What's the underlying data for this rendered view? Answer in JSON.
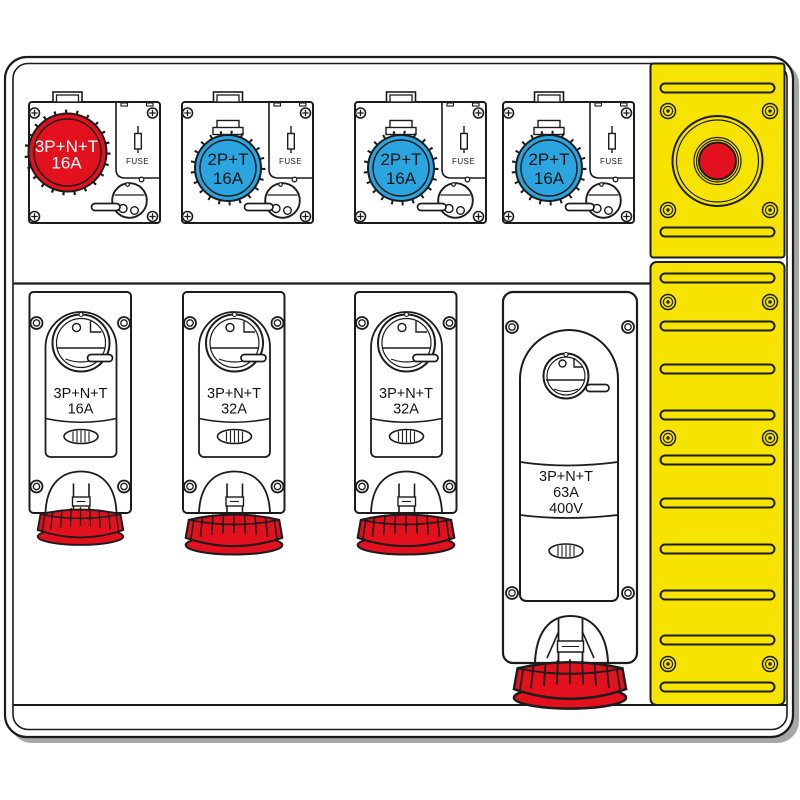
{
  "board": {
    "description": "Portable power distribution board technical illustration",
    "colors": {
      "socket_red": "#e3101e",
      "socket_blue": "#2aa5df",
      "panel_yellow": "#f6e300",
      "cap_red": "#e3101e",
      "estop_red": "#e3101e",
      "line": "#1c1c1c"
    }
  },
  "top_units": [
    {
      "socket_line1": "3P+N+T",
      "socket_line2": "16A",
      "fuse_label": "FUSE"
    },
    {
      "socket_line1": "2P+T",
      "socket_line2": "16A",
      "fuse_label": "FUSE"
    },
    {
      "socket_line1": "2P+T",
      "socket_line2": "16A",
      "fuse_label": "FUSE"
    },
    {
      "socket_line1": "2P+T",
      "socket_line2": "16A",
      "fuse_label": "FUSE"
    }
  ],
  "bottom_units": [
    {
      "line1": "3P+N+T",
      "line2": "16A"
    },
    {
      "line1": "3P+N+T",
      "line2": "32A"
    },
    {
      "line1": "3P+N+T",
      "line2": "32A"
    },
    {
      "line1": "3P+N+T",
      "line2": "63A",
      "line3": "400V"
    }
  ]
}
